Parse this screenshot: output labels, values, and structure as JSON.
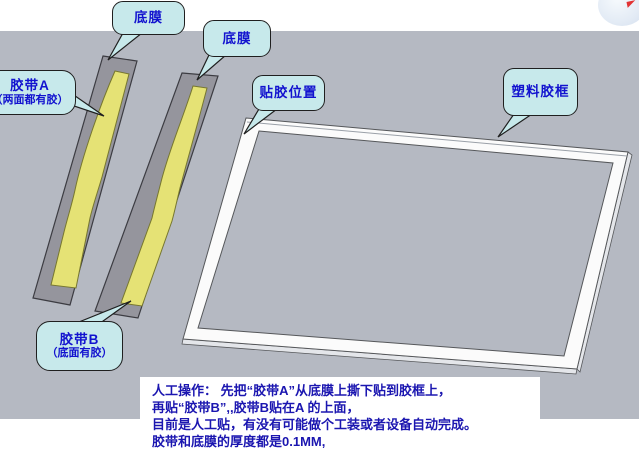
{
  "scene": {
    "background_color": "#b5b9c2",
    "strip_gray": "#95959d",
    "tape_yellow": "#e5e275",
    "frame_white": "#fbfbfb",
    "bubble_fill": "#c7e9eb",
    "bubble_text_color": "#1212cf",
    "note_text_color": "#1b16b0"
  },
  "callouts": [
    {
      "id": "bottom-film-1",
      "label": "底膜"
    },
    {
      "id": "bottom-film-2",
      "label": "底膜"
    },
    {
      "id": "tape-a",
      "label": "胶带A",
      "label2": "（两面都有胶）"
    },
    {
      "id": "paste-position",
      "label": "贴胶位置"
    },
    {
      "id": "plastic-frame",
      "label": "塑料胶框"
    },
    {
      "id": "tape-b",
      "label": "胶带B",
      "label2": "（底面有胶）"
    }
  ],
  "note": {
    "lines": [
      "人工操作： 先把“胶带A”从底膜上撕下贴到胶框上，",
      "再贴“胶带B”,,胶带B贴在A 的上面，",
      "目前是人工贴，有没有可能做个工装或者设备自动完成。",
      "胶带和底膜的厚度都是0.1MM,"
    ]
  }
}
